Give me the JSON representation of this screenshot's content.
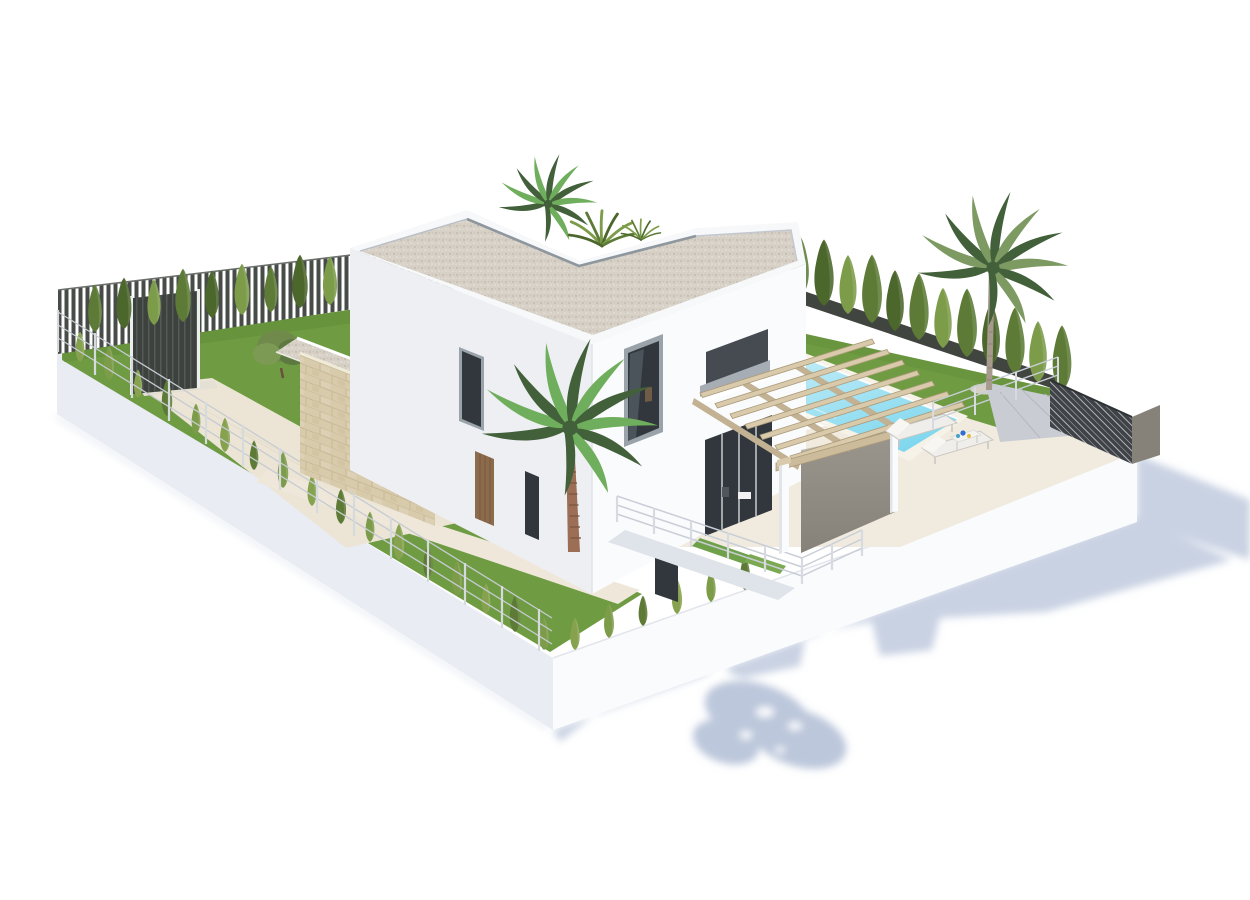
{
  "scene": {
    "type": "3d-architectural-render",
    "title": "Isometric 3D rendering of a modern two-storey white villa with flat gravel roof, landscaped garden, cypress hedges, palm trees, swimming pool, wooden pergola and sun loungers on a white background",
    "background": "#ffffff",
    "palette": {
      "background": "#ffffff",
      "shadow": "#c9d2e3",
      "shadow_deep": "#bcc7db",
      "wall_bright": "#fafbfd",
      "wall_shade": "#edeff3",
      "wall_mid": "#f3f4f7",
      "plinth_shade": "#e9ecf3",
      "roof_white": "#f7f8fa",
      "gravel": "#d6d0c6",
      "gravel_dot_dark": "#c2bbad",
      "gravel_dot_light": "#e8e3d9",
      "coping": "#8e969e",
      "stone": "#d8cbab",
      "stone_line": "#c3b28e",
      "grass": "#6f9c43",
      "grass_dark": "#5a8334",
      "cypress": "#5d7b36",
      "cypress_dark": "#4c672c",
      "cypress_light": "#7d9c4a",
      "hedge_light": "#86a24f",
      "frond_dark": "#42603a",
      "frond_light": "#6fae5c",
      "frond_grey": "#7c9a62",
      "pool_deep": "#7fd7ee",
      "pool_light": "#c6eef8",
      "pool_coping": "#f6f2e8",
      "deck": "#f1ebdf",
      "path": "#efe8da",
      "drive": "#ece5d6",
      "wood_beam": "#d9caac",
      "wood_dark": "#ab9a78",
      "door_wood": "#8b6b4c",
      "door_line": "#78573c",
      "glass_dark": "#31373d",
      "glass_reflect": "#6e7881",
      "frame_grey": "#9aa2aa",
      "slat_fence": "#474c48",
      "gate": "#3d423e",
      "gate_line": "#5a5f5b",
      "hedge_fence": "#40453f",
      "wire": "#c6cbd1",
      "wire_post": "#d6dadd",
      "screen_taupe": "#9a968e",
      "screen_taupe_dark": "#86827a",
      "lattice": "#3f4347",
      "lattice_line": "#caccce",
      "lounger": "#efeeea",
      "lounger_line": "#c9c7c2",
      "trunk": "#9b6e55",
      "trunk_dark": "#7d5540",
      "trunk_grey": "#a59a8c",
      "trunk_grey_dark": "#8f8374",
      "balcony_gravel": "#a7adb4",
      "deck_grey": "#c9ccd2",
      "deck_grey_line": "#b5b8bf",
      "railing": "#c9ced6",
      "item_blue": "#2f6fd4",
      "item_yellow": "#e4bf3e",
      "item_teal": "#46a0c8",
      "olive": "#6f8a4a",
      "olive_dark": "#5d7840",
      "olive_light": "#7d9a55",
      "patio_recess": "#dfe3ea",
      "mat_green": "#6fa04a",
      "mat_green2": "#7aa952"
    },
    "elements": [
      {
        "name": "villa",
        "label": "Modern two-storey white villa"
      },
      {
        "name": "flat-gravel-roof",
        "label": "L-shaped flat roof finished with light gravel and metal coping"
      },
      {
        "name": "roof-terrace-plants",
        "label": "Palm head and ornamental grasses emerging from roof terrace notch"
      },
      {
        "name": "stone-clad-garage",
        "label": "Single-storey wing clad in beige natural stone with slot window"
      },
      {
        "name": "driveway",
        "label": "Cream paved driveway from entrance gate"
      },
      {
        "name": "entrance-gate",
        "label": "Dark vertical-slat entrance gate in boundary fence"
      },
      {
        "name": "slat-fence",
        "label": "Dark vertical slat fence along rear-left boundary"
      },
      {
        "name": "wire-fence",
        "label": "Light wire mesh fence on white plinth along front-left boundary"
      },
      {
        "name": "lawn-left",
        "label": "Large green lawn on left side of plot"
      },
      {
        "name": "lawn-right",
        "label": "Green lawn strip behind the pool"
      },
      {
        "name": "cypress-hedges",
        "label": "Rows of young cypress trees along all boundaries"
      },
      {
        "name": "front-palm-tree",
        "label": "Large fan palm in front of the facade"
      },
      {
        "name": "right-palm-tree",
        "label": "Slender palm beside the pool"
      },
      {
        "name": "swimming-pool",
        "label": "Turquoise rectangular swimming pool with light coping"
      },
      {
        "name": "pool-deck",
        "label": "Cream stone pool deck and terrace"
      },
      {
        "name": "pergola",
        "label": "Light timber pergola on white pillars over the terrace"
      },
      {
        "name": "sun-loungers",
        "label": "Two white sun loungers with small drinks table"
      },
      {
        "name": "drinks-table",
        "label": "Small white table with blue and yellow items"
      },
      {
        "name": "privacy-screens",
        "label": "Dark lattice and taupe privacy screens at east corner"
      },
      {
        "name": "sunken-patio",
        "label": "Sunken basement patio with white railings and green mats"
      },
      {
        "name": "glass-window-wall",
        "label": "Full-height dark glazing on the right facade"
      },
      {
        "name": "cast-shadow",
        "label": "Soft blue-grey shadow cast on the white ground"
      }
    ]
  }
}
